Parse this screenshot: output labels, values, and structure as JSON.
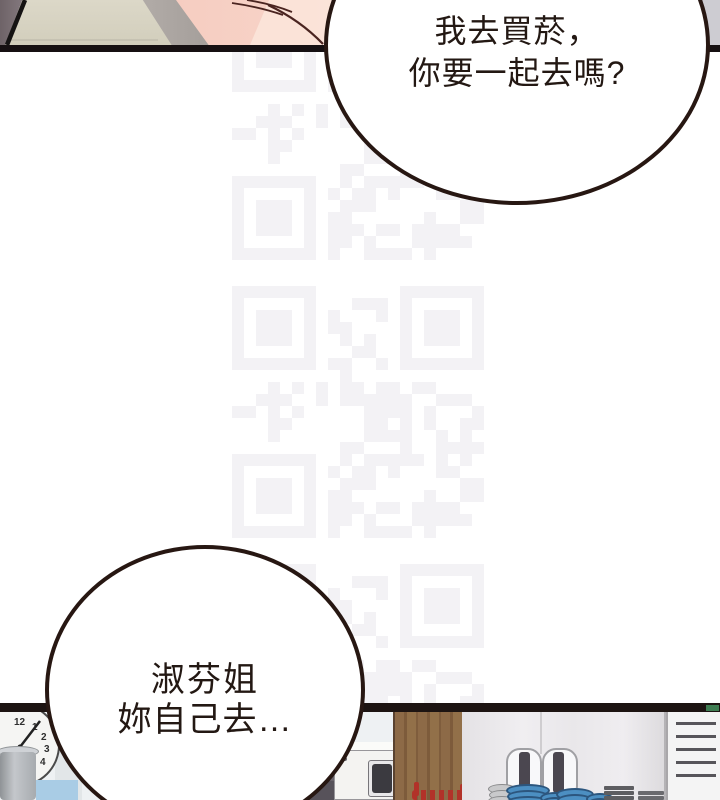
{
  "comic": {
    "bubbles": {
      "top": {
        "line1": "我去買菸，",
        "line2": "你要一起去嗎?"
      },
      "bottom": {
        "line1": "淑芬姐",
        "line2": "妳自己去…"
      }
    },
    "clock": {
      "numbers": [
        "12",
        "1",
        "2",
        "3",
        "4"
      ]
    },
    "colors": {
      "bubble_border": "#271712",
      "text": "#231813",
      "panel_border_top": "#161012",
      "panel_border_bottom": "#1d1412",
      "watermark": "#f3f2f5",
      "skin_pink": "#f6cdc1",
      "wood": "#8d6a47",
      "plate_blue": "#4c8fc2",
      "utensil_red": "#b23229"
    }
  }
}
